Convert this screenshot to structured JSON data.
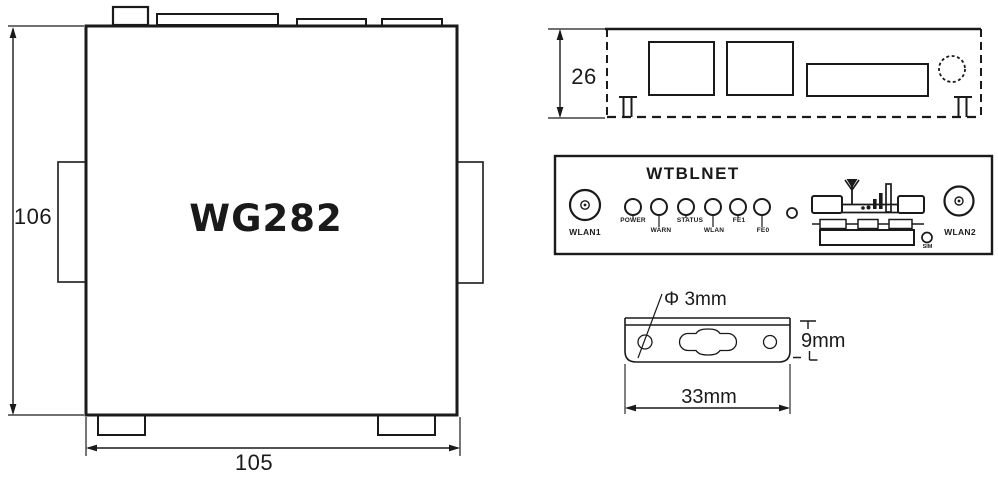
{
  "drawing": {
    "top_view": {
      "model": "WG282",
      "height_dim": "106",
      "width_dim": "105"
    },
    "side_view": {
      "height_dim": "26"
    },
    "front_panel": {
      "brand": "WTBLNET",
      "wlan1_label": "WLAN1",
      "wlan2_label": "WLAN2",
      "sim_label": "SIM",
      "leds": [
        "POWER",
        "WARN",
        "STATUS",
        "WLAN",
        "FE1",
        "FE0"
      ]
    },
    "bracket": {
      "hole_dim": "Φ 3mm",
      "height_dim": "9mm",
      "width_dim": "33mm"
    },
    "colors": {
      "line": "#1a1a1a",
      "background": "#ffffff"
    }
  }
}
